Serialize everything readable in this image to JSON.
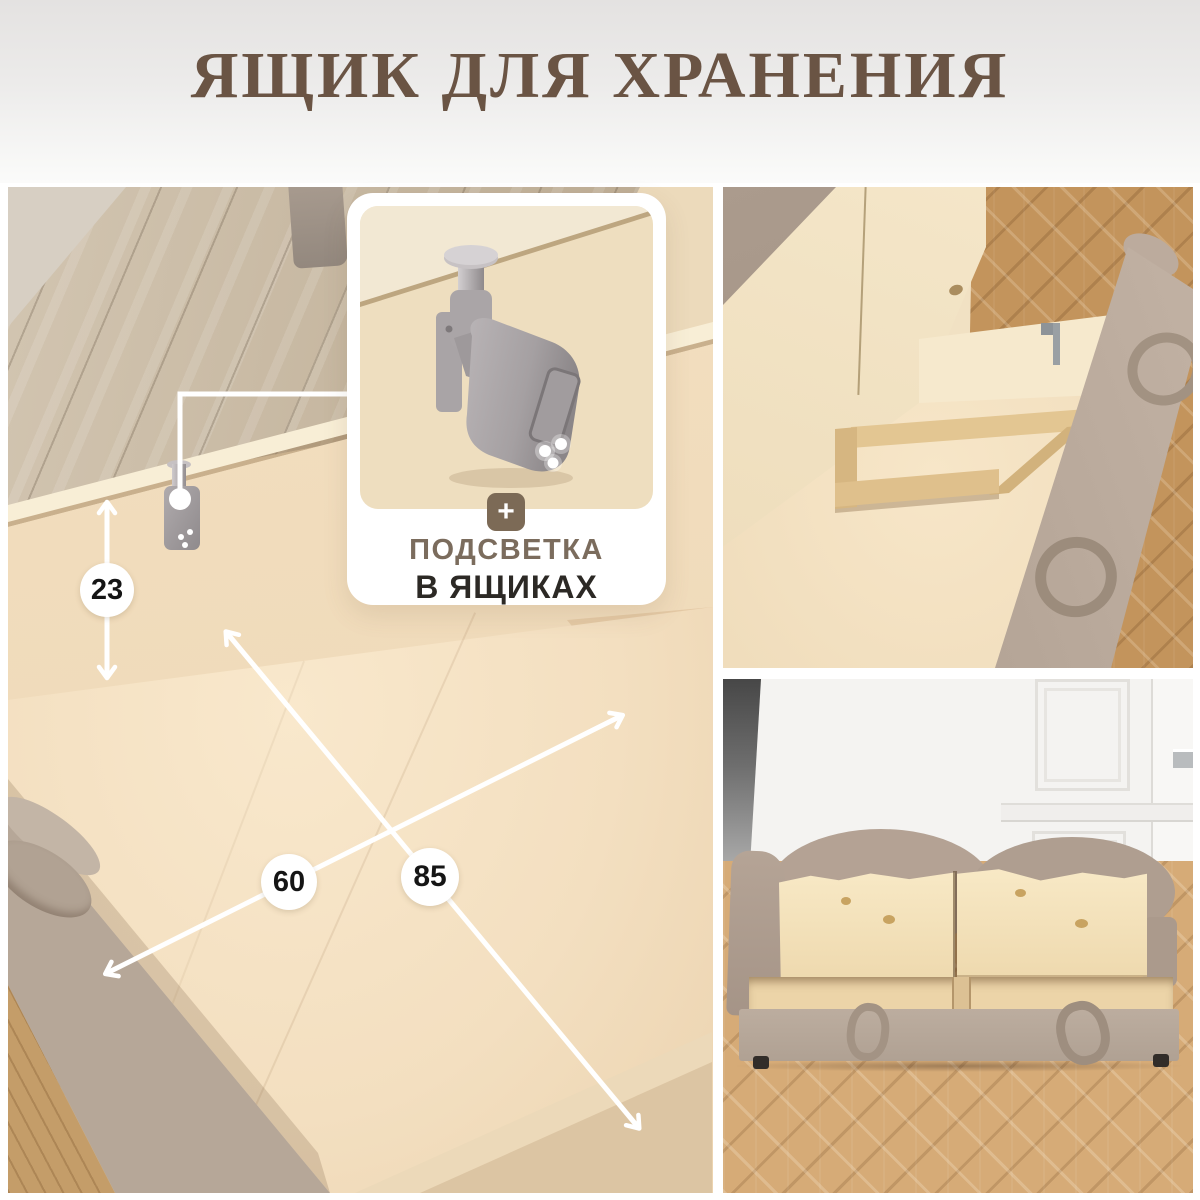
{
  "header": {
    "title": "ЯЩИК ДЛЯ ХРАНЕНИЯ",
    "title_color": "#6a5444"
  },
  "callout": {
    "plus_icon": "+",
    "badge_color": "#7c6a56",
    "title_line1": "ПОДСВЕТКА",
    "title_line1_color": "#7b6c5d",
    "title_line2": "В ЯЩИКАХ",
    "title_line2_color": "#2c2925"
  },
  "dimensions": {
    "height_cm": "23",
    "width_cm": "60",
    "length_cm": "85"
  },
  "annotations": {
    "line_color": "#ffffff",
    "label_text_color": "#151515"
  }
}
